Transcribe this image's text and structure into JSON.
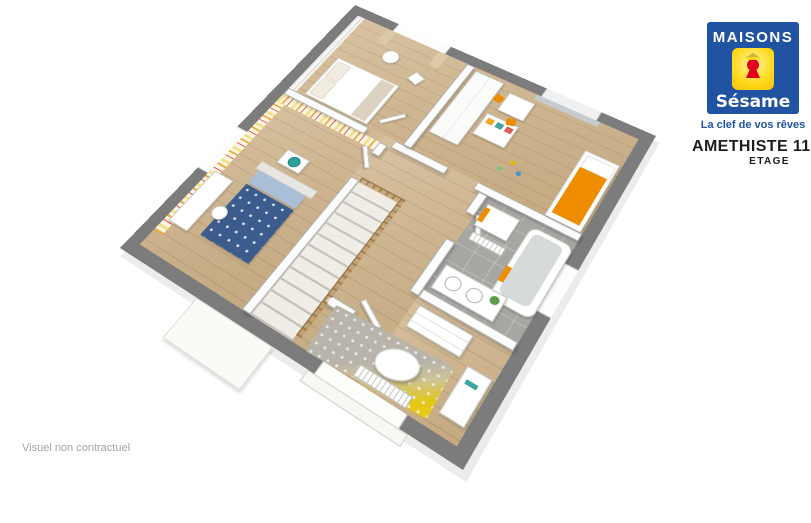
{
  "brand": {
    "name_top": "MAISONS",
    "name_bottom": "Sésame",
    "tagline": "La clef de vos rêves",
    "icon": "keyhole-icon",
    "colors": {
      "blue": "#2153a3",
      "yellow": "#ffd816",
      "red": "#e2001a"
    }
  },
  "header": {
    "title": "AMETHISTE 110 GI",
    "subtitle": "ETAGE"
  },
  "footer": {
    "disclaimer": "Visuel non contractuel"
  },
  "palette": {
    "exterior_wall_gray": "#7c7c7c",
    "interior_wall_white": "#fdfdfd",
    "floor_wood": "#cdb48f",
    "bathroom_floor_gray": "#a7a6a3",
    "accent_orange": "#ef8d00",
    "bed_blue": "#3d5c8e",
    "rug_yellow": "#e3c714",
    "stair_rail_wood": "#a8804e"
  }
}
